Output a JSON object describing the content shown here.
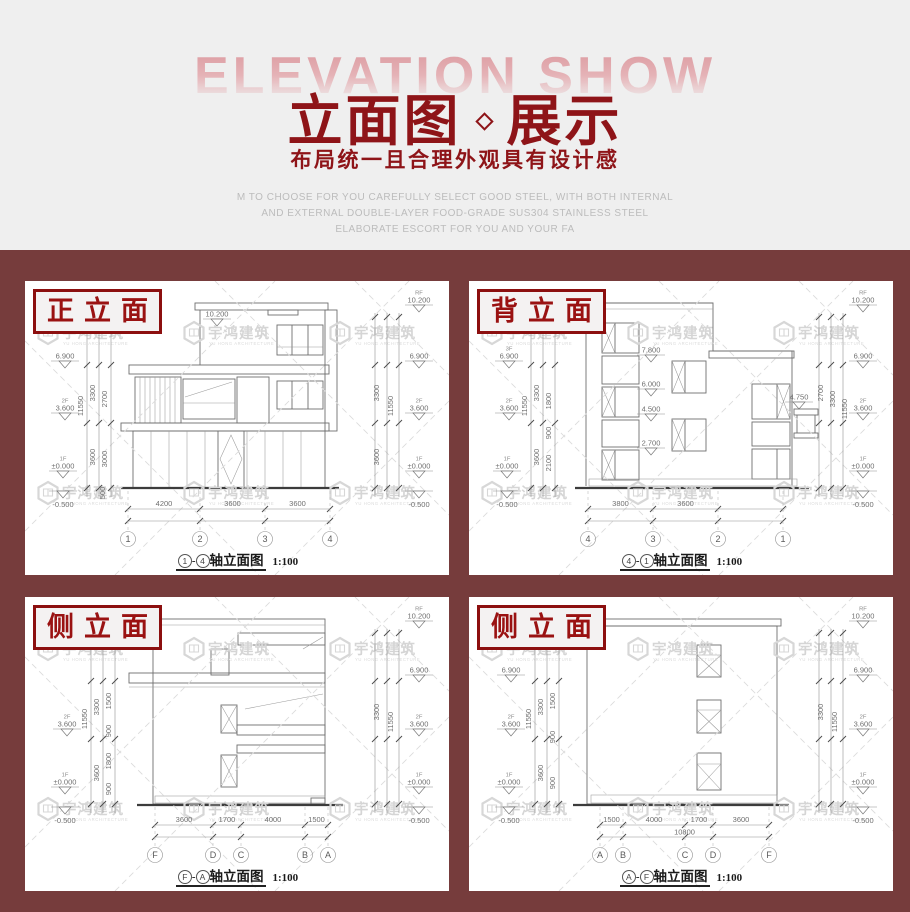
{
  "header": {
    "backdrop_text": "ELEVATION SHOW",
    "title_left": "立面图",
    "title_right": "展示",
    "subtitle": "布局统一且合理外观具有设计感",
    "description_lines": [
      "M TO CHOOSE FOR YOU CAREFULLY SELECT GOOD STEEL, WITH BOTH INTERNAL",
      "AND EXTERNAL DOUBLE-LAYER FOOD-GRADE SUS304 STAINLESS STEEL",
      "ELABORATE ESCORT FOR YOU AND YOUR FA"
    ]
  },
  "watermark": {
    "brand": "宇鸿建筑",
    "brand_sub": "YU HONG ARCHITECTURE"
  },
  "panels": [
    {
      "label": "正立面",
      "cap_from": "1",
      "cap_to": "4",
      "cap_text": "轴立面图",
      "cap_scale": "1:100",
      "axes": [
        "1",
        "2",
        "3",
        "4"
      ],
      "bottom_dims": [
        "4200",
        "3600",
        "3600"
      ],
      "total_dim": "",
      "top_marker": "10.200",
      "mid_markers": [],
      "left_markers": [
        {
          "fl": "",
          "v": "6.900"
        },
        {
          "fl": "2F",
          "v": "3.600"
        },
        {
          "fl": "1F",
          "v": "±0.000"
        },
        {
          "fl": "",
          "v": "-0.500"
        }
      ],
      "right_markers": [
        {
          "fl": "RF",
          "v": "10.200"
        },
        {
          "fl": "",
          "v": "6.900"
        },
        {
          "fl": "2F",
          "v": "3.600"
        },
        {
          "fl": "1F",
          "v": "±0.000"
        },
        {
          "fl": "",
          "v": "-0.500"
        }
      ],
      "v_dims": [
        "11550",
        "3300",
        "3600",
        "2700",
        "3000",
        "500",
        "3300",
        "3600",
        "11550"
      ]
    },
    {
      "label": "背立面",
      "cap_from": "4",
      "cap_to": "1",
      "cap_text": "轴立面图",
      "cap_scale": "1:100",
      "axes": [
        "4",
        "3",
        "2",
        "1"
      ],
      "bottom_dims": [
        "3800",
        "3600",
        ""
      ],
      "total_dim": "",
      "top_marker": "",
      "mid_markers": [
        {
          "v": "7.800"
        },
        {
          "v": "6.000"
        },
        {
          "v": "4.500"
        },
        {
          "v": "2.700"
        },
        {
          "v": "4.750"
        }
      ],
      "left_markers": [
        {
          "fl": "3F",
          "v": "6.900"
        },
        {
          "fl": "2F",
          "v": "3.600"
        },
        {
          "fl": "1F",
          "v": "±0.000"
        },
        {
          "fl": "",
          "v": "-0.500"
        }
      ],
      "right_markers": [
        {
          "fl": "RF",
          "v": "10.200"
        },
        {
          "fl": "",
          "v": "6.900"
        },
        {
          "fl": "2F",
          "v": "3.600"
        },
        {
          "fl": "1F",
          "v": "±0.000"
        },
        {
          "fl": "",
          "v": "-0.500"
        }
      ],
      "v_dims": [
        "11550",
        "3300",
        "3600",
        "1800",
        "900",
        "2100",
        "2700",
        "3300",
        "11550"
      ]
    },
    {
      "label": "侧立面",
      "cap_from": "F",
      "cap_to": "A",
      "cap_text": "轴立面图",
      "cap_scale": "1:100",
      "axes": [
        "F",
        "D",
        "C",
        "B",
        "A"
      ],
      "bottom_dims": [
        "3600",
        "1700",
        "4000",
        "1500"
      ],
      "total_dim": "",
      "top_marker": "",
      "mid_markers": [],
      "left_markers": [
        {
          "fl": "2F",
          "v": "3.600"
        },
        {
          "fl": "1F",
          "v": "±0.000"
        },
        {
          "fl": "",
          "v": "-0.500"
        }
      ],
      "right_markers": [
        {
          "fl": "RF",
          "v": "10.200"
        },
        {
          "fl": "",
          "v": "6.900"
        },
        {
          "fl": "2F",
          "v": "3.600"
        },
        {
          "fl": "1F",
          "v": "±0.000"
        },
        {
          "fl": "",
          "v": "-0.500"
        }
      ],
      "v_dims": [
        "11550",
        "3300",
        "3600",
        "1500",
        "900",
        "1800",
        "900",
        "3300",
        "11550"
      ]
    },
    {
      "label": "侧立面",
      "cap_from": "A",
      "cap_to": "F",
      "cap_text": "轴立面图",
      "cap_scale": "1:100",
      "axes": [
        "A",
        "B",
        "C",
        "D",
        "F"
      ],
      "bottom_dims": [
        "1500",
        "4000",
        "1700",
        "3600"
      ],
      "total_dim": "10800",
      "top_marker": "",
      "mid_markers": [],
      "left_markers": [
        {
          "fl": "",
          "v": "6.900"
        },
        {
          "fl": "2F",
          "v": "3.600"
        },
        {
          "fl": "1F",
          "v": "±0.000"
        },
        {
          "fl": "",
          "v": "-0.500"
        }
      ],
      "right_markers": [
        {
          "fl": "RF",
          "v": "10.200"
        },
        {
          "fl": "",
          "v": "6.900"
        },
        {
          "fl": "2F",
          "v": "3.600"
        },
        {
          "fl": "1F",
          "v": "±0.000"
        },
        {
          "fl": "",
          "v": "-0.500"
        }
      ],
      "v_dims": [
        "11550",
        "3300",
        "3600",
        "1500",
        "900",
        "900",
        "3300",
        "11550"
      ]
    }
  ]
}
